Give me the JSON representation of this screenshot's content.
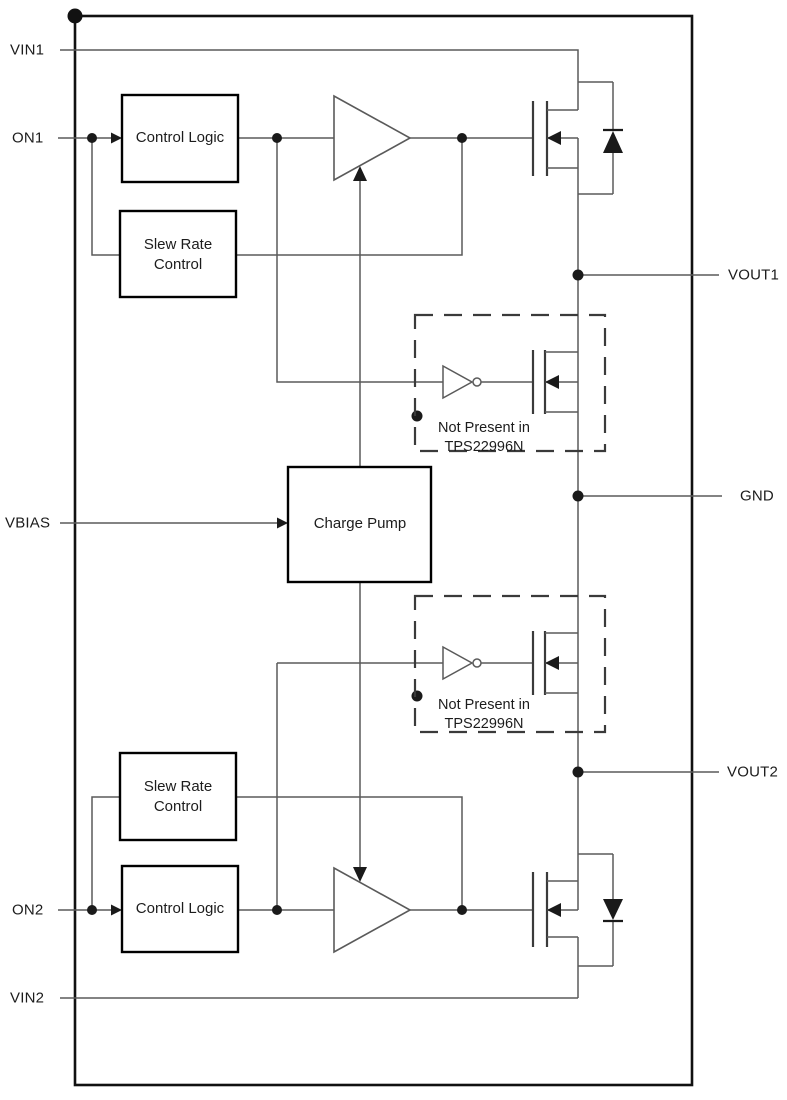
{
  "device": {
    "part_number_note": "TPS22996N"
  },
  "pins": {
    "vin1": "VIN1",
    "on1": "ON1",
    "vbias": "VBIAS",
    "on2": "ON2",
    "vin2": "VIN2",
    "vout1": "VOUT1",
    "gnd": "GND",
    "vout2": "VOUT2"
  },
  "blocks": {
    "control_logic_1": "Control Logic",
    "slew_rate_1": {
      "line1": "Slew Rate",
      "line2": "Control"
    },
    "charge_pump": "Charge Pump",
    "slew_rate_2": {
      "line1": "Slew Rate",
      "line2": "Control"
    },
    "control_logic_2": "Control Logic"
  },
  "notes": {
    "qod_1": {
      "line1": "Not Present in",
      "line2": "TPS22996N"
    },
    "qod_2": {
      "line1": "Not Present in",
      "line2": "TPS22996N"
    }
  },
  "colors": {
    "wire": "#5a5a5a",
    "device": "#3a3a3a",
    "outline": "#111111",
    "background": "#ffffff"
  }
}
